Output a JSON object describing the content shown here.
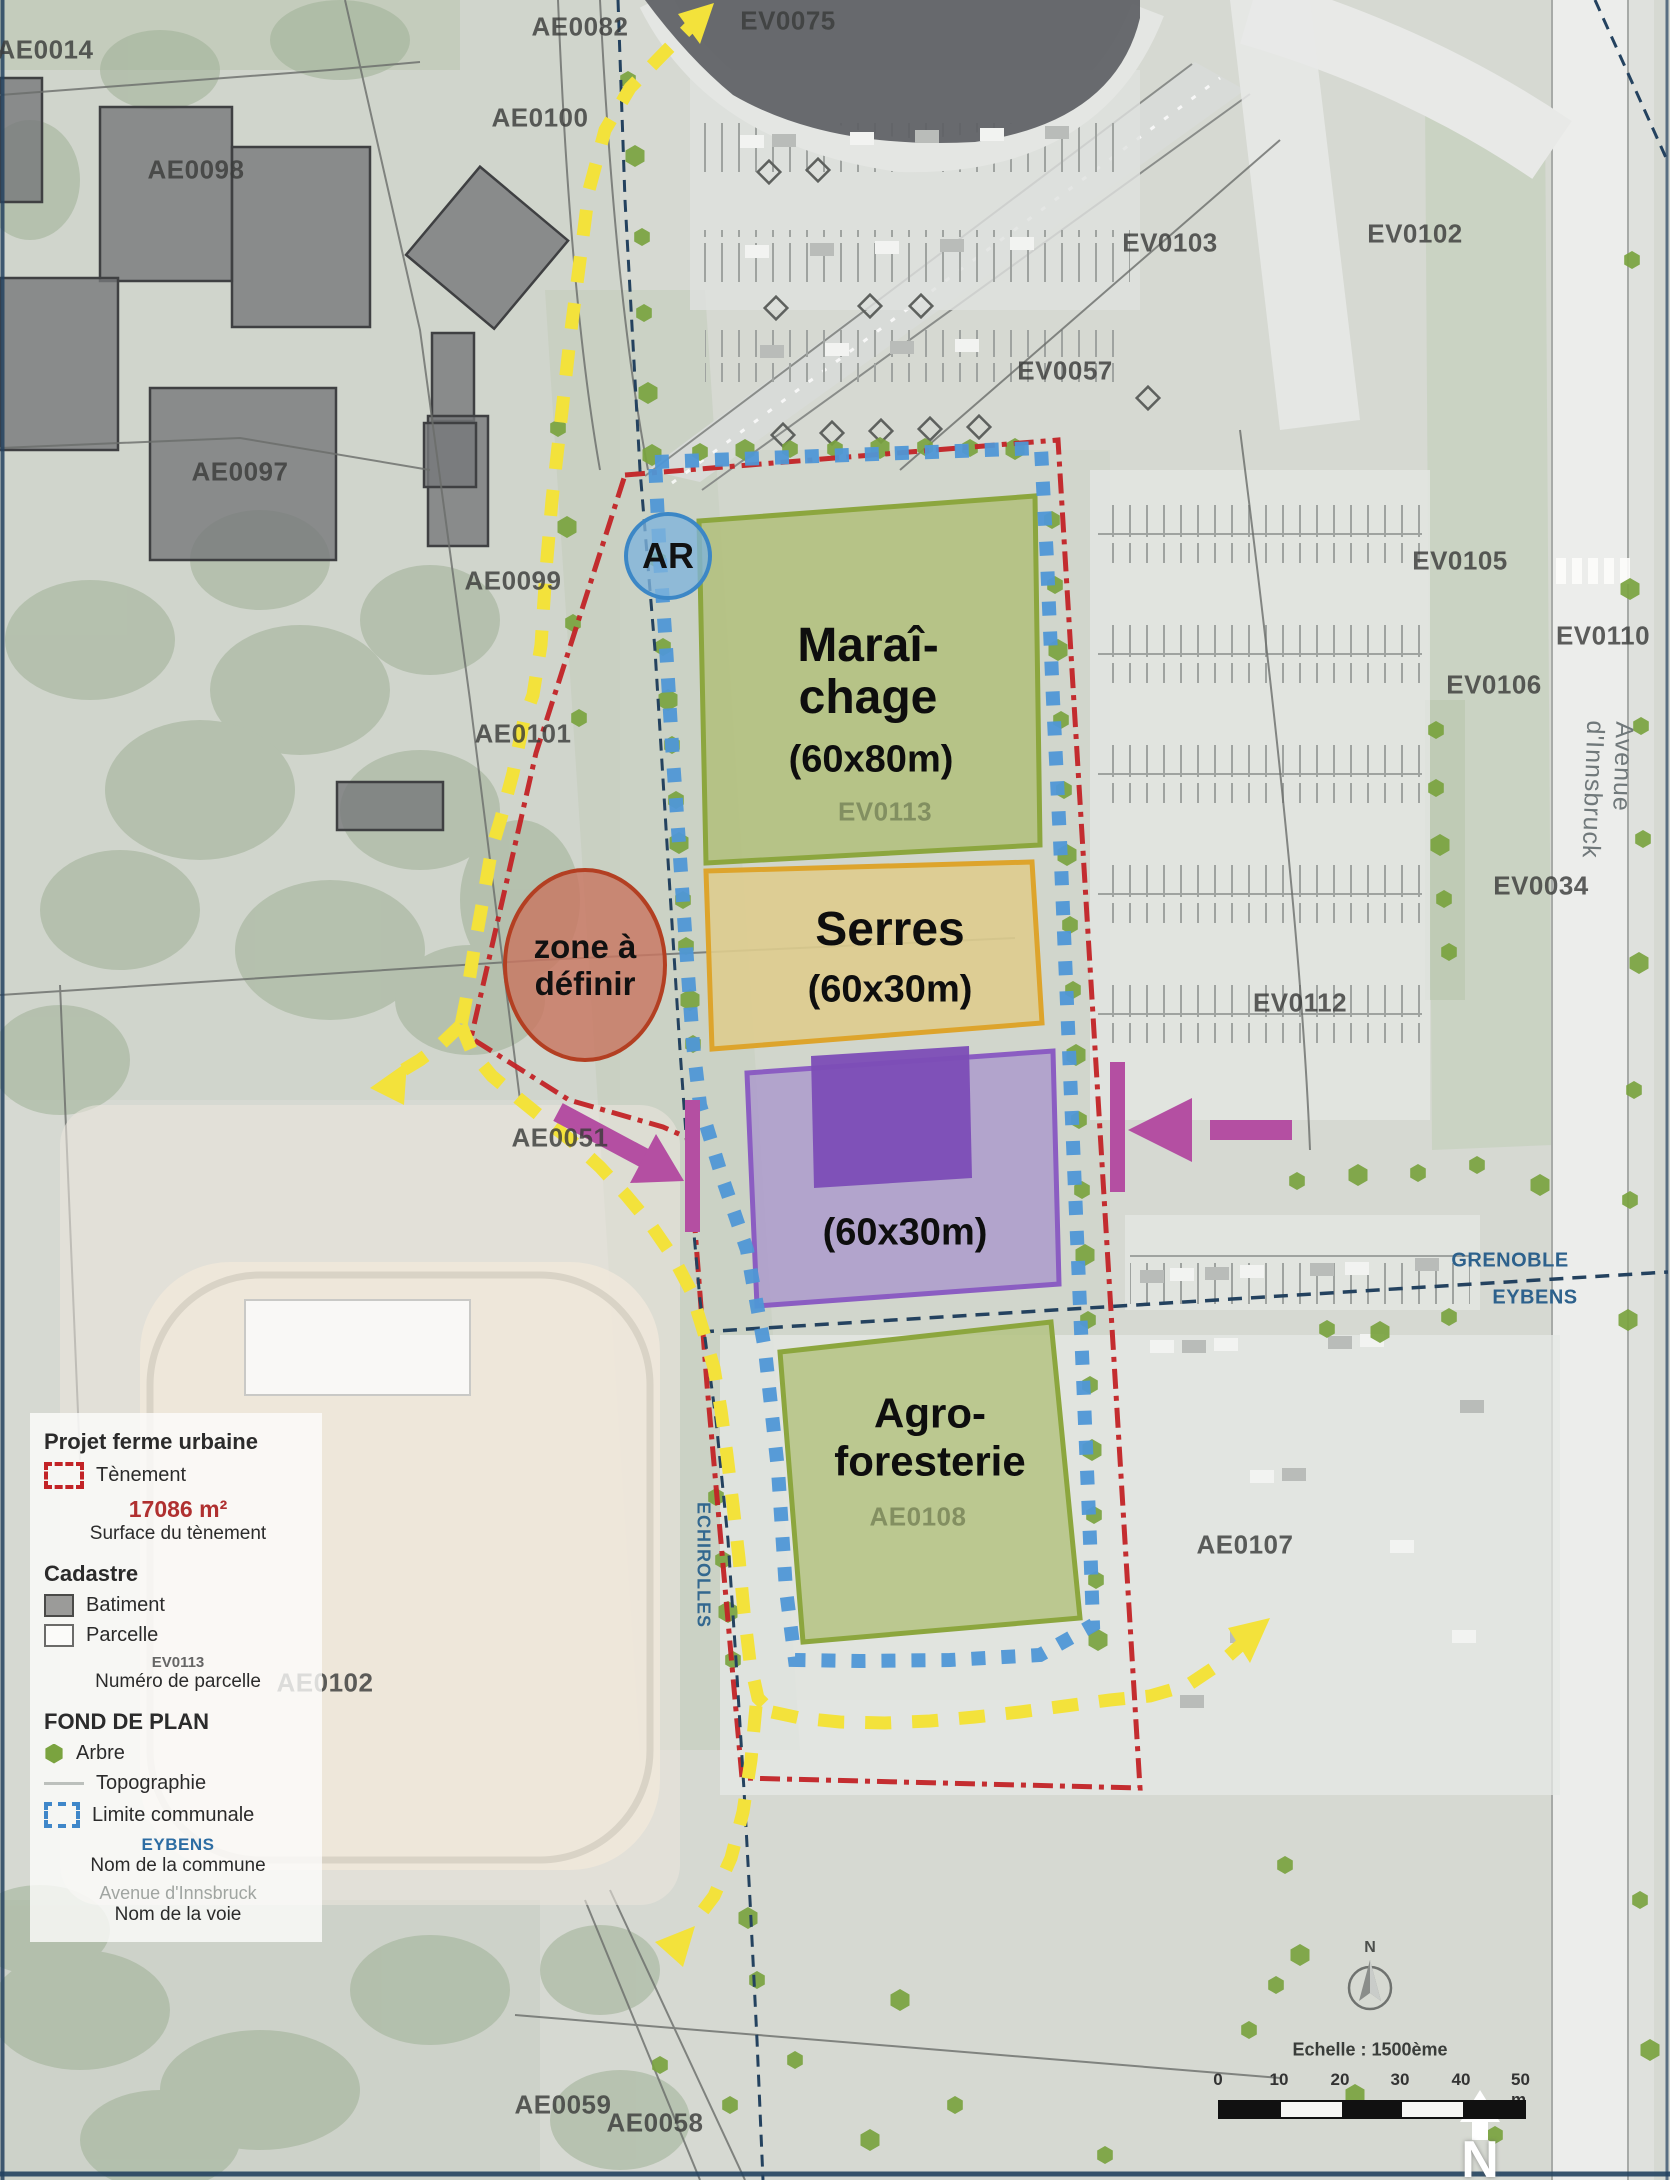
{
  "map": {
    "annotations": {
      "ar": "AR",
      "zad_line1": "zone à",
      "zad_line2": "définir"
    },
    "zones": [
      {
        "id": "maraichage",
        "line1": "Maraî-",
        "line2": "chage",
        "size": "(60x80m)",
        "parcel": "EV0113"
      },
      {
        "id": "serres",
        "line1": "Serres",
        "size": "(60x30m)"
      },
      {
        "id": "batiment-agricole",
        "size": "(60x30m)"
      },
      {
        "id": "agroforesterie",
        "line1": "Agro-",
        "line2": "foresterie",
        "parcel": "AE0108"
      }
    ],
    "communes": {
      "grenoble": "GRENOBLE",
      "eybens": "EYBENS",
      "echirolles": "ECHIROLLES"
    },
    "street": "Avenue d'Innsbruck",
    "parcels": [
      {
        "id": "AE0014",
        "x": 45,
        "y": 50
      },
      {
        "id": "AE0082",
        "x": 580,
        "y": 27
      },
      {
        "id": "AE0100",
        "x": 540,
        "y": 118
      },
      {
        "id": "AE0098",
        "x": 196,
        "y": 170
      },
      {
        "id": "EV0075",
        "x": 788,
        "y": 21
      },
      {
        "id": "EV0103",
        "x": 1170,
        "y": 243
      },
      {
        "id": "EV0102",
        "x": 1415,
        "y": 234
      },
      {
        "id": "EV0057",
        "x": 1065,
        "y": 371
      },
      {
        "id": "AE0097",
        "x": 240,
        "y": 472
      },
      {
        "id": "AE0099",
        "x": 513,
        "y": 581
      },
      {
        "id": "AE0101",
        "x": 523,
        "y": 734
      },
      {
        "id": "EV0105",
        "x": 1460,
        "y": 561
      },
      {
        "id": "EV0110",
        "x": 1603,
        "y": 636
      },
      {
        "id": "EV0106",
        "x": 1494,
        "y": 685
      },
      {
        "id": "EV0034",
        "x": 1541,
        "y": 886
      },
      {
        "id": "EV0112",
        "x": 1300,
        "y": 1003
      },
      {
        "id": "AE0051",
        "x": 560,
        "y": 1138
      },
      {
        "id": "AE0102",
        "x": 325,
        "y": 1683
      },
      {
        "id": "AE0107",
        "x": 1245,
        "y": 1545
      },
      {
        "id": "AE0059",
        "x": 563,
        "y": 2105
      },
      {
        "id": "AE0058",
        "x": 655,
        "y": 2123
      },
      {
        "id": "EV0113",
        "x": 885,
        "y": 812,
        "cls": "green"
      },
      {
        "id": "AE0108",
        "x": 918,
        "y": 1517,
        "cls": "green"
      }
    ],
    "trees": [
      [
        635,
        156
      ],
      [
        642,
        237
      ],
      [
        644,
        313
      ],
      [
        648,
        393
      ],
      [
        628,
        80
      ],
      [
        558,
        428
      ],
      [
        567,
        527
      ],
      [
        573,
        623
      ],
      [
        579,
        718
      ],
      [
        652,
        455
      ],
      [
        658,
        560
      ],
      [
        663,
        647
      ],
      [
        668,
        700
      ],
      [
        672,
        745
      ],
      [
        676,
        800
      ],
      [
        679,
        843
      ],
      [
        683,
        900
      ],
      [
        686,
        946
      ],
      [
        690,
        1000
      ],
      [
        693,
        1044
      ],
      [
        700,
        452
      ],
      [
        745,
        450
      ],
      [
        790,
        449
      ],
      [
        835,
        449
      ],
      [
        880,
        448
      ],
      [
        925,
        447
      ],
      [
        970,
        448
      ],
      [
        1015,
        449
      ],
      [
        1052,
        520
      ],
      [
        1055,
        585
      ],
      [
        1058,
        650
      ],
      [
        1061,
        720
      ],
      [
        1064,
        790
      ],
      [
        1067,
        855
      ],
      [
        1070,
        925
      ],
      [
        1073,
        990
      ],
      [
        1076,
        1055
      ],
      [
        1079,
        1120
      ],
      [
        1082,
        1190
      ],
      [
        1085,
        1255
      ],
      [
        1088,
        1320
      ],
      [
        1090,
        1385
      ],
      [
        1092,
        1450
      ],
      [
        1094,
        1515
      ],
      [
        1096,
        1580
      ],
      [
        1098,
        1640
      ],
      [
        716,
        1497
      ],
      [
        723,
        1560
      ],
      [
        728,
        1612
      ],
      [
        733,
        1660
      ],
      [
        1297,
        1181
      ],
      [
        1358,
        1175
      ],
      [
        1418,
        1173
      ],
      [
        1477,
        1165
      ],
      [
        1540,
        1185
      ],
      [
        1327,
        1329
      ],
      [
        1449,
        1317
      ],
      [
        1380,
        1332
      ],
      [
        1436,
        730
      ],
      [
        1436,
        788
      ],
      [
        1440,
        845
      ],
      [
        1444,
        899
      ],
      [
        1449,
        952
      ],
      [
        1630,
        589
      ],
      [
        1641,
        726
      ],
      [
        1643,
        839
      ],
      [
        1639,
        963
      ],
      [
        1634,
        1090
      ],
      [
        1630,
        1200
      ],
      [
        1628,
        1320
      ],
      [
        1632,
        260
      ],
      [
        1285,
        1865
      ],
      [
        1300,
        1955
      ],
      [
        1276,
        1985
      ],
      [
        1249,
        2030
      ],
      [
        1355,
        2095
      ],
      [
        1495,
        2135
      ],
      [
        1640,
        1900
      ],
      [
        1650,
        2050
      ],
      [
        955,
        2105
      ],
      [
        730,
        2105
      ],
      [
        870,
        2140
      ],
      [
        1105,
        2155
      ],
      [
        660,
        2065
      ],
      [
        748,
        1918
      ],
      [
        757,
        1980
      ],
      [
        795,
        2060
      ],
      [
        900,
        2000
      ]
    ]
  },
  "legend": {
    "title1": "Projet ferme urbaine",
    "tenement": "Tènement",
    "area_value": "17086 m²",
    "area_label": "Surface du tènement",
    "title2": "Cadastre",
    "batiment": "Batiment",
    "parcelle": "Parcelle",
    "parcel_example": "EV0113",
    "parcel_number_label": "Numéro de parcelle",
    "title3": "FOND DE PLAN",
    "arbre": "Arbre",
    "topographie": "Topographie",
    "limite": "Limite communale",
    "commune_example": "EYBENS",
    "commune_label": "Nom de la commune",
    "street_example": "Avenue d'Innsbruck",
    "street_label": "Nom de la voie"
  },
  "scalebar": {
    "title": "Echelle : 1500ème",
    "ticks": [
      "0",
      "10",
      "20",
      "30",
      "40",
      "50 m"
    ],
    "north": "N"
  },
  "colors": {
    "tenement_red": "#c22326",
    "commune_blue": "#4f97d6",
    "path_yellow": "#f3e23b",
    "access_magenta": "#b44fa2",
    "zone_green_border": "#8ca63e",
    "serres_orange": "#dda42c",
    "zone_purple": "#8b5dc2",
    "tree_green": "#7aa33f",
    "commune_navy": "#24425f",
    "commune_label_blue": "#2d618c",
    "surface_red": "#b03030"
  }
}
